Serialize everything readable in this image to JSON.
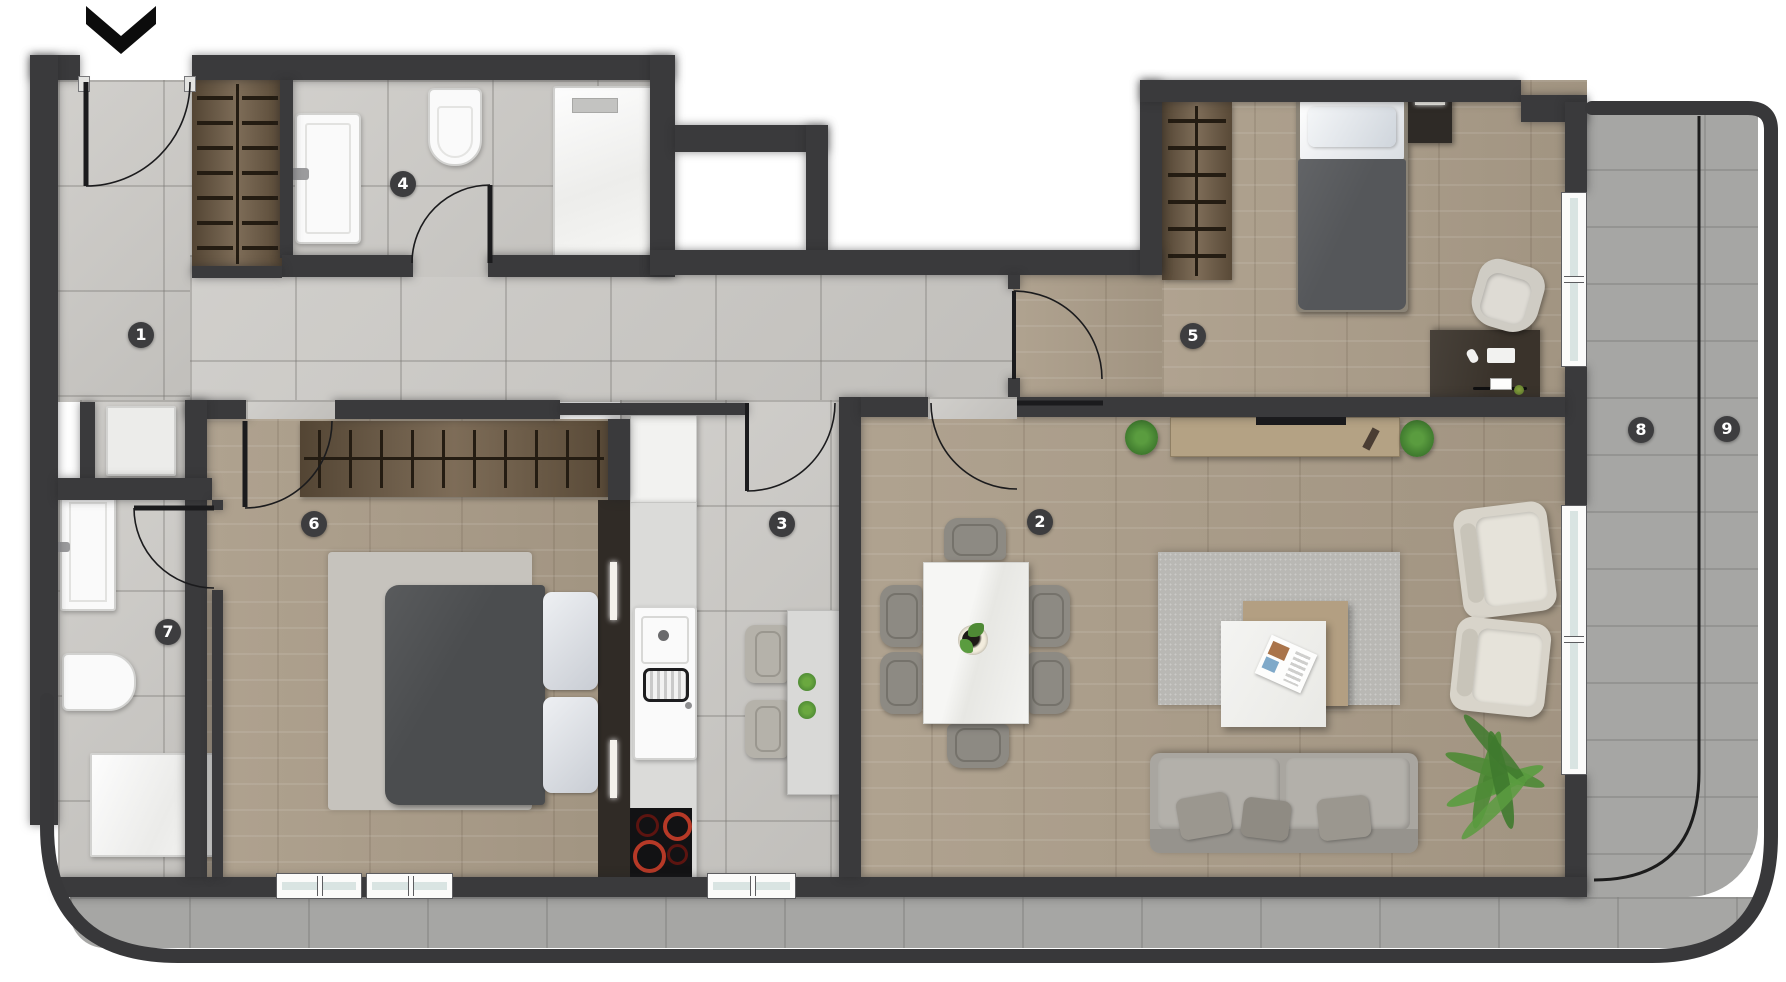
{
  "floorplan": {
    "title": "apartment-floor-plan",
    "room_labels": [
      {
        "number": "1"
      },
      {
        "number": "2"
      },
      {
        "number": "3"
      },
      {
        "number": "4"
      },
      {
        "number": "5"
      },
      {
        "number": "6"
      },
      {
        "number": "7"
      },
      {
        "number": "8"
      },
      {
        "number": "9"
      }
    ],
    "icons": {
      "entrance_arrow": "chevron-down"
    },
    "colors": {
      "wall": "#3a3a3c",
      "tile_floor": "#cbc9c5",
      "wood_floor": "#ab9d89",
      "balcony_floor": "#a6a6a4",
      "label_background": "#3d3d3f",
      "label_text": "#ffffff",
      "wardrobe_wood": "#6f5c45",
      "burner_red": "#b63927",
      "plant_green": "#4e8a35",
      "fixture_white": "#fafafa",
      "sofa_gray": "#a9a6a0"
    }
  }
}
